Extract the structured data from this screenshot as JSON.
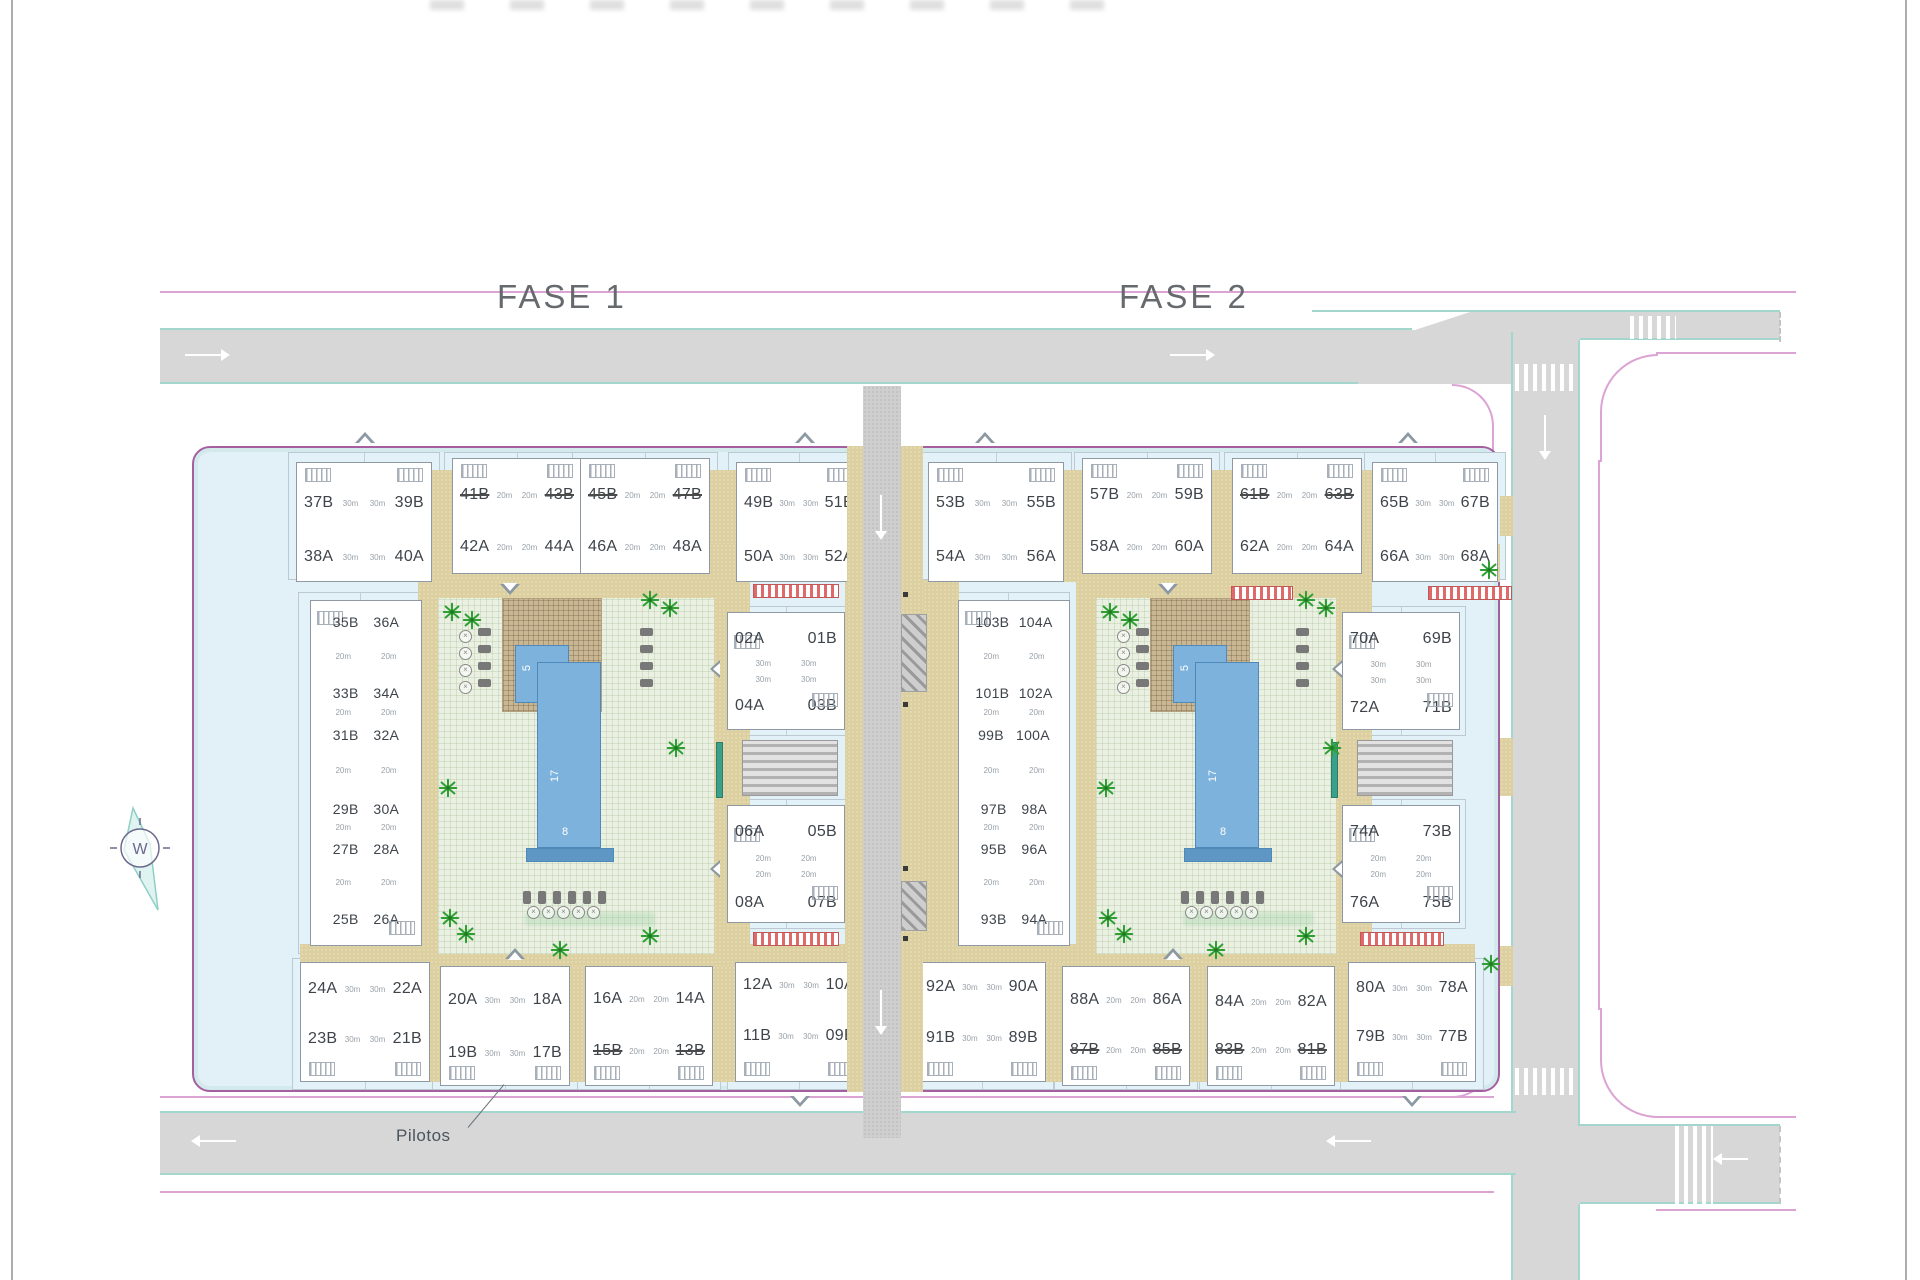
{
  "drawing": {
    "phase1_title": "FASE 1",
    "phase2_title": "FASE 2",
    "pilotos_label": "Pilotos",
    "compass_letter": "W"
  },
  "pool": {
    "width_label": "5",
    "length_label": "17",
    "edge_label": "8"
  },
  "colors": {
    "road_gray": "#d7d7d7",
    "road_edge_teal": "#a3d7cd",
    "boundary_pink": "#dca4d4",
    "site_outline": "#a55fa0",
    "site_fill": "#e2f0f7",
    "paving_tan": "#ddd0a0",
    "courtyard_green": "#eaf0e2",
    "pool_blue": "#7db2dc",
    "palm_green": "#2f9e33",
    "unit_text": "#3e444a"
  },
  "blocks": [
    {
      "key": "f1t1",
      "area_label": "30m",
      "rows": [
        [
          "37B",
          "39B"
        ],
        [
          "38A",
          "40A"
        ]
      ],
      "struck": []
    },
    {
      "key": "f1t2",
      "area_label": "20m",
      "rows": [
        [
          "41B",
          "43B"
        ],
        [
          "42A",
          "44A"
        ]
      ],
      "struck": [
        "41B",
        "43B"
      ]
    },
    {
      "key": "f1t3",
      "area_label": "20m",
      "rows": [
        [
          "45B",
          "47B"
        ],
        [
          "46A",
          "48A"
        ]
      ],
      "struck": [
        "45B",
        "47B"
      ]
    },
    {
      "key": "f1t4",
      "area_label": "30m",
      "rows": [
        [
          "49B",
          "51B"
        ],
        [
          "50A",
          "52A"
        ]
      ],
      "struck": []
    },
    {
      "key": "f2t1",
      "area_label": "30m",
      "rows": [
        [
          "53B",
          "55B"
        ],
        [
          "54A",
          "56A"
        ]
      ],
      "struck": []
    },
    {
      "key": "f2t2",
      "area_label": "20m",
      "rows": [
        [
          "57B",
          "59B"
        ],
        [
          "58A",
          "60A"
        ]
      ],
      "struck": []
    },
    {
      "key": "f2t3",
      "area_label": "20m",
      "rows": [
        [
          "61B",
          "63B"
        ],
        [
          "62A",
          "64A"
        ]
      ],
      "struck": [
        "61B",
        "63B"
      ]
    },
    {
      "key": "f2t4",
      "area_label": "30m",
      "rows": [
        [
          "65B",
          "67B"
        ],
        [
          "66A",
          "68A"
        ]
      ],
      "struck": []
    },
    {
      "key": "f1col",
      "area_label": "20m",
      "rows": [
        [
          "35B",
          "36A"
        ],
        [
          "33B",
          "34A"
        ],
        [
          "31B",
          "32A"
        ],
        [
          "29B",
          "30A"
        ],
        [
          "27B",
          "28A"
        ],
        [
          "25B",
          "26A"
        ]
      ],
      "struck": []
    },
    {
      "key": "f2col",
      "area_label": "20m",
      "rows": [
        [
          "103B",
          "104A"
        ],
        [
          "101B",
          "102A"
        ],
        [
          "99B",
          "100A"
        ],
        [
          "97B",
          "98A"
        ],
        [
          "95B",
          "96A"
        ],
        [
          "93B",
          "94A"
        ]
      ],
      "struck": []
    },
    {
      "key": "f1m1",
      "area_label": "30m",
      "rows": [
        [
          "02A",
          "01B"
        ],
        [
          "04A",
          "03B"
        ]
      ],
      "struck": []
    },
    {
      "key": "f1m2",
      "area_label": "20m",
      "rows": [
        [
          "06A",
          "05B"
        ],
        [
          "08A",
          "07B"
        ]
      ],
      "struck": []
    },
    {
      "key": "f2m1",
      "area_label": "30m",
      "rows": [
        [
          "70A",
          "69B"
        ],
        [
          "72A",
          "71B"
        ]
      ],
      "struck": []
    },
    {
      "key": "f2m2",
      "area_label": "20m",
      "rows": [
        [
          "74A",
          "73B"
        ],
        [
          "76A",
          "75B"
        ]
      ],
      "struck": []
    },
    {
      "key": "f1b1",
      "area_label": "30m",
      "rows": [
        [
          "24A",
          "22A"
        ],
        [
          "23B",
          "21B"
        ]
      ],
      "struck": []
    },
    {
      "key": "f1b2",
      "area_label": "30m",
      "rows": [
        [
          "20A",
          "18A"
        ],
        [
          "19B",
          "17B"
        ]
      ],
      "struck": []
    },
    {
      "key": "f1b3",
      "area_label": "20m",
      "rows": [
        [
          "16A",
          "14A"
        ],
        [
          "15B",
          "13B"
        ]
      ],
      "struck": [
        "15B",
        "13B"
      ]
    },
    {
      "key": "f1b4",
      "area_label": "30m",
      "rows": [
        [
          "12A",
          "10A"
        ],
        [
          "11B",
          "09B"
        ]
      ],
      "struck": []
    },
    {
      "key": "f2b1",
      "area_label": "30m",
      "rows": [
        [
          "92A",
          "90A"
        ],
        [
          "91B",
          "89B"
        ]
      ],
      "struck": []
    },
    {
      "key": "f2b2",
      "area_label": "20m",
      "rows": [
        [
          "88A",
          "86A"
        ],
        [
          "87B",
          "85B"
        ]
      ],
      "struck": [
        "87B",
        "85B"
      ]
    },
    {
      "key": "f2b3",
      "area_label": "20m",
      "rows": [
        [
          "84A",
          "82A"
        ],
        [
          "83B",
          "81B"
        ]
      ],
      "struck": [
        "83B",
        "81B"
      ]
    },
    {
      "key": "f2b4",
      "area_label": "30m",
      "rows": [
        [
          "80A",
          "78A"
        ],
        [
          "79B",
          "77B"
        ]
      ],
      "struck": []
    }
  ]
}
